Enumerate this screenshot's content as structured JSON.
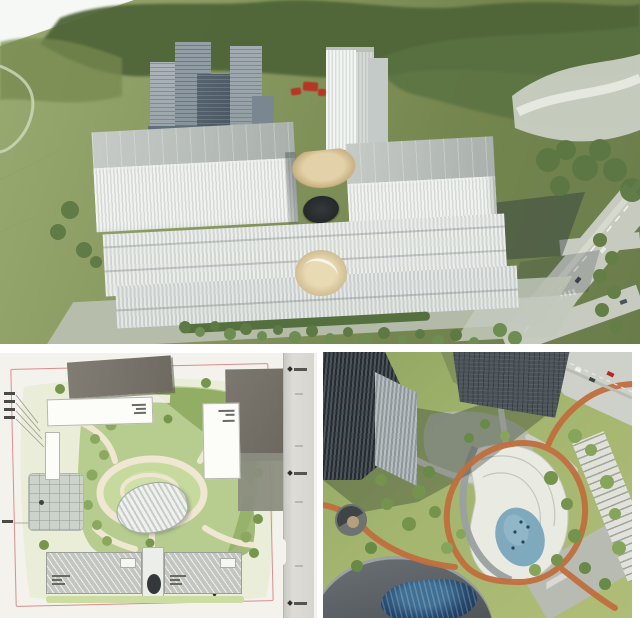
{
  "meta": {
    "width": 640,
    "height": 618
  },
  "colors": {
    "annotation-red": "#c0261b",
    "boundary-pink": "#d98e8e",
    "track-orange": "#c06f3e",
    "pond-blue": "#7fa9bd",
    "dome-blue": "#24466b",
    "lawn-green": "#b7cd8f",
    "olive-green": "#8fab62",
    "path-cream": "#efe7d2",
    "facade-white": "#eff1ef",
    "glass-dark": "#4e5a66",
    "road-gray": "#c6cabf",
    "forest-green": "#4f6539"
  },
  "panels": {
    "hero": {
      "label": "aerial rendering of white twin-tower complex in green landscape with red annotation"
    },
    "site_plan": {
      "label": "landscape site plan drawing with red site boundary, central green courtyard and road strip"
    },
    "courtyard": {
      "label": "aerial rendering of courtyard park with orange looping track, pond and glass dome"
    }
  }
}
